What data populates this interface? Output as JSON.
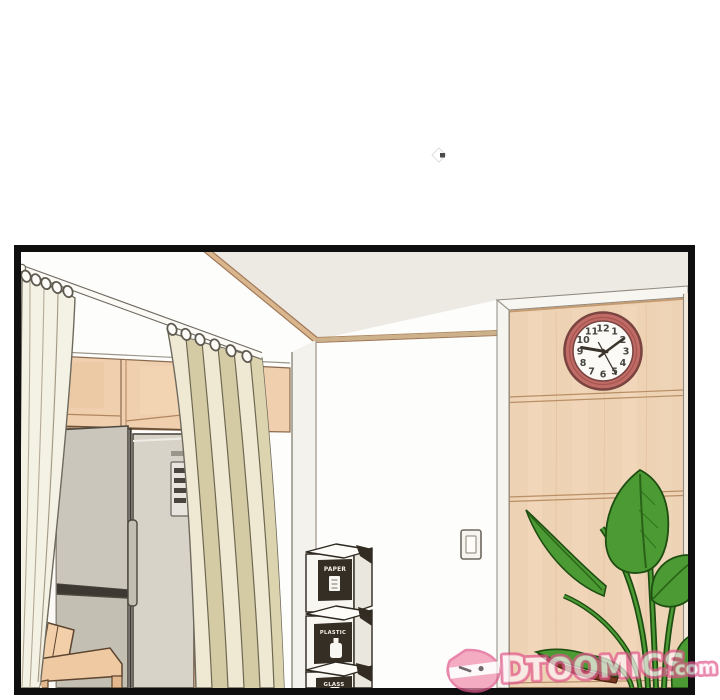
{
  "clock": {
    "numbers": [
      "1",
      "2",
      "3",
      "4",
      "5",
      "6",
      "7",
      "8",
      "9",
      "10",
      "11",
      "12"
    ],
    "time_shown": "9:10",
    "rim_color": "#c16b66",
    "face_color": "#fbfaf6"
  },
  "bins": {
    "labels": [
      "PAPER",
      "PLASTIC",
      "GLASS"
    ]
  },
  "watermark": {
    "logo_letter": "D",
    "brand": "TOOMICS",
    "suffix": ".com",
    "pink": "#ee6f9f"
  },
  "colors": {
    "panel_border": "#0f0f0f",
    "ceiling": "#edeae4",
    "wall": "#fdfdfb",
    "wood_cabinet": "#eed2b4",
    "wood_trim": "#d9b68d",
    "curtain_cream": "#f4f1e5",
    "curtain_olive": "#d4cba4",
    "fridge_gray": "#d7d3c8",
    "leaf_green": "#4b9a33"
  }
}
